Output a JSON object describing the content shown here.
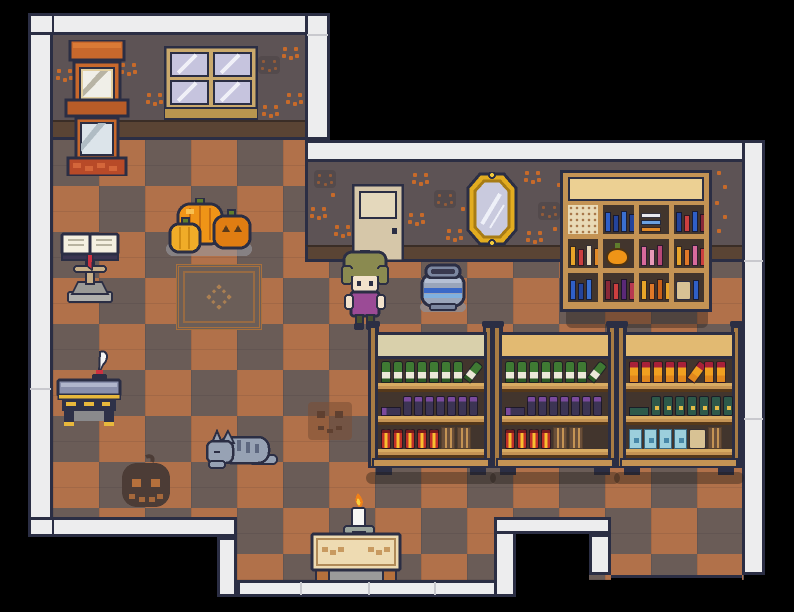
{
  "meta": {
    "scene_name": "halloween-shop-interior",
    "description": "top-down pixel RPG room: checkered floor, pumpkin-patterned walls, shop shelves with bottles, bookshelf, player character"
  },
  "palette": {
    "o": "#2b2e44",
    "bw": "#ededee",
    "seam": "#c9c9ce",
    "wall": "#5d5355",
    "wallFaceD": "#534a4c",
    "dot": "#c76a2a",
    "base": "#5a4434",
    "floorD": "#6a5c57",
    "floorO": "#b1714a",
    "wood": "#c49354",
    "woodD": "#8a6234",
    "shelfIn": "#42352d",
    "capPale": "#d9d0ab",
    "capGold": "#e2ba72",
    "banner": "#ecd093",
    "door": "#d6c7a9",
    "doorPanel": "#e4d8bc",
    "glass": "#c6c6de",
    "gold": "#e2ac20",
    "goldD": "#a87c14",
    "skin": "#f2e2cc",
    "hair": "#8a8a50",
    "dress": "#9b4b96",
    "legs": "#4b5130",
    "potBody": "#9aa5ba",
    "potRim": "#7c87a0",
    "potBlue1": "#3a68c8",
    "potBlue2": "#7fb0e0",
    "catBody": "#97a2b4",
    "catStripe": "#5e6880",
    "rugLine": "#a8703c",
    "pumpkinOrange": "#ef9417",
    "pumpkinYellow": "#f0ac28",
    "pumpkinDark": "#e07d12",
    "stemGreen": "#5f7d2c",
    "flameOuter": "#f08018",
    "flameInner": "#f8d040",
    "tableWood": "#eedbb2",
    "tableLeg": "#b5703c",
    "deskTop": "#8a90ac",
    "deskGold": "#e8b83c",
    "ribbonRed": "#cc3040",
    "btlGreen": "#3f7a33",
    "btlGreenD": "#2c5a24",
    "btlPurple": "#3c3454",
    "btlPurpleCap": "#7a4a9c",
    "btlRed": "#c23028",
    "btlGlow": "#f8c030",
    "btlSauce": "#f0a020",
    "btlSauceCap": "#a82038",
    "btlTeal": "#2d594a",
    "btlTealDot": "#e2bc48",
    "btlCyan": "#9ccfdc",
    "btlCyanDot": "#4888a8"
  },
  "scene": {
    "objects": [
      "framed-pictures-stack",
      "window",
      "door",
      "oval-mirror",
      "bookshelf",
      "blue-pot",
      "player-character",
      "pumpkin-group",
      "floor-rug",
      "book-lectern",
      "writing-desk-with-quill",
      "sleeping-cat",
      "dark-pumpkin-floor-decal",
      "pumpkin-face-floor-tile",
      "candle-table",
      "store-shelf-unit-1",
      "store-shelf-unit-2",
      "store-shelf-unit-3",
      "south-exit-doorway"
    ],
    "wall_faces": [
      [
        56,
        68,
        "o"
      ],
      [
        120,
        62,
        "o"
      ],
      [
        146,
        92,
        "o"
      ],
      [
        258,
        56,
        "d"
      ],
      [
        282,
        46,
        "o"
      ],
      [
        286,
        92,
        "o"
      ],
      [
        262,
        104,
        "o"
      ],
      [
        314,
        170,
        "d"
      ],
      [
        310,
        206,
        "o"
      ],
      [
        334,
        224,
        "o"
      ],
      [
        412,
        172,
        "o"
      ],
      [
        434,
        190,
        "d"
      ],
      [
        408,
        212,
        "o"
      ],
      [
        446,
        228,
        "o"
      ],
      [
        524,
        170,
        "o"
      ],
      [
        538,
        202,
        "d"
      ],
      [
        526,
        230,
        "o"
      ],
      [
        556,
        182,
        "s"
      ],
      [
        552,
        226,
        "s"
      ],
      [
        330,
        192,
        "s"
      ],
      [
        460,
        206,
        "s"
      ],
      [
        716,
        170,
        "s"
      ],
      [
        722,
        184,
        "s"
      ],
      [
        714,
        200,
        "s"
      ],
      [
        722,
        214,
        "s"
      ],
      [
        716,
        228,
        "s"
      ]
    ],
    "bookshelf": {
      "cells": [
        {
          "type": "lace"
        },
        {
          "type": "books",
          "colors": [
            "#2f5fc8",
            "#24449c",
            "#3a6fd0",
            "#24449c"
          ]
        },
        {
          "type": "hstack",
          "colors": [
            "#e8e8ee",
            "#6aa0e0",
            "#e08a28"
          ]
        },
        {
          "type": "books",
          "colors": [
            "#24449c",
            "#cc3f3f",
            "#2f5fc8",
            "#8a2838"
          ]
        },
        {
          "type": "books",
          "colors": [
            "#e8a428",
            "#cc3f3f",
            "#e8d8b8",
            "#e08a28"
          ]
        },
        {
          "type": "pumpkin"
        },
        {
          "type": "books",
          "colors": [
            "#d86a9c",
            "#e89ab8",
            "#b84878"
          ]
        },
        {
          "type": "books",
          "colors": [
            "#e8a428",
            "#e07828",
            "#d86a9c",
            "#cc3f3f"
          ]
        },
        {
          "type": "books",
          "colors": [
            "#2f5fc8",
            "#24449c",
            "#3a6fd0"
          ]
        },
        {
          "type": "books",
          "colors": [
            "#8a2838",
            "#cc3f3f",
            "#5a2878",
            "#b83850"
          ]
        },
        {
          "type": "books",
          "colors": [
            "#e8a428",
            "#e07828",
            "#c86018",
            "#e8a428"
          ]
        },
        {
          "type": "boxcell",
          "colors": [
            "#2f5fc8"
          ]
        }
      ]
    },
    "shelf_units": [
      {
        "cap": "pale",
        "rows": [
          [
            "green",
            "green",
            "green",
            "green",
            "green",
            "green",
            "green",
            "green_t"
          ],
          [
            "purple_l",
            "purple",
            "purple",
            "purple",
            "purple",
            "purple",
            "purple",
            "purple"
          ],
          [
            "red",
            "red",
            "red",
            "red",
            "red",
            "slot",
            "slot"
          ]
        ]
      },
      {
        "cap": "gold",
        "rows": [
          [
            "green",
            "green",
            "green",
            "green",
            "green",
            "green",
            "green",
            "green_t"
          ],
          [
            "purple_l",
            "purple",
            "purple",
            "purple",
            "purple",
            "purple",
            "purple",
            "purple"
          ],
          [
            "red",
            "red",
            "red",
            "red",
            "slot",
            "slot"
          ]
        ]
      },
      {
        "cap": "gold",
        "rows": [
          [
            "sauce",
            "sauce",
            "sauce",
            "sauce",
            "sauce",
            "sauce_t",
            "sauce",
            "sauce"
          ],
          [
            "teal_l",
            "teal",
            "teal",
            "teal",
            "teal",
            "teal",
            "teal",
            "teal"
          ],
          [
            "cyan",
            "cyan",
            "cyan",
            "cyan",
            "boxit",
            "slot"
          ]
        ]
      }
    ]
  }
}
